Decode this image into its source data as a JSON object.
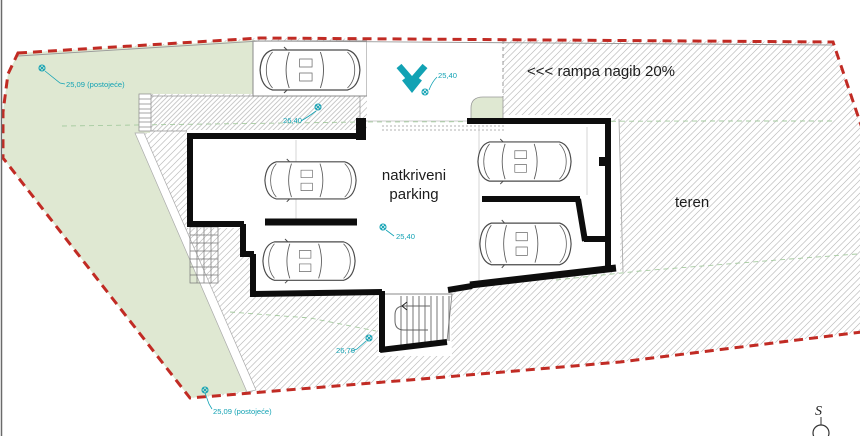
{
  "drawing": {
    "labels": {
      "ramp": "<<< rampa nagib 20%",
      "parking_line1": "natkriveni",
      "parking_line2": "parking",
      "terrain": "teren",
      "north": "S"
    },
    "elevations": {
      "existing_top": "25,09 (postojeće)",
      "existing_bottom": "25,09 (postojeće)",
      "ramp_entry": "25,40",
      "band": "26,40",
      "parking_floor": "25,40",
      "stairs": "26,70"
    },
    "colors": {
      "boundary_red": "#c12b24",
      "green_area": "#dfe8d2",
      "marker_teal": "#12a2b4",
      "contour_green": "#a6cba0",
      "hatch_line": "#bdbdbd",
      "wall_black": "#0d0d0d"
    },
    "icons": {
      "ramp_chevron": "chevron-down",
      "elevation_marker": "survey-point",
      "car": "car-top-view",
      "north_arrow": "compass-north"
    }
  }
}
